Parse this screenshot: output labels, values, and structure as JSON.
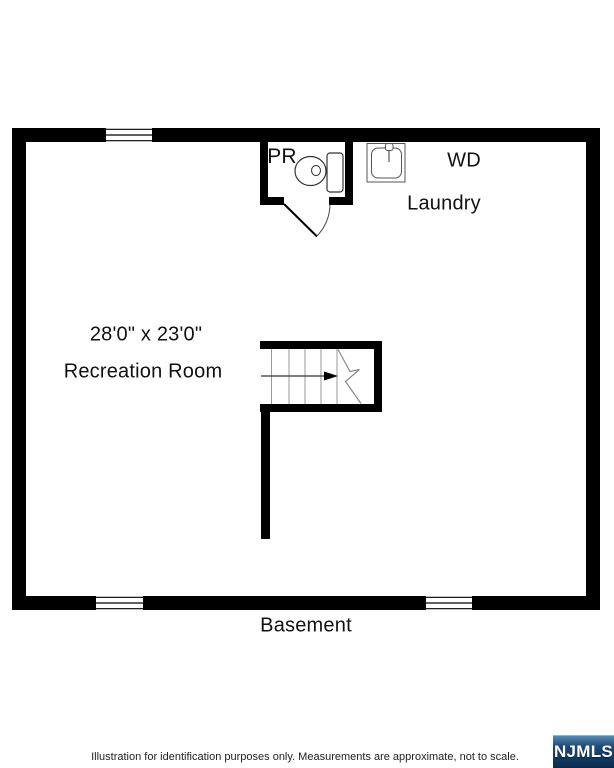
{
  "plan": {
    "powder_room": {
      "label": "PR"
    },
    "laundry_area": {
      "wd_label": "WD",
      "label": "Laundry"
    },
    "recreation_room": {
      "dimensions": "28'0\" x 23'0\"",
      "label": "Recreation Room"
    },
    "basement_label": "Basement"
  },
  "footer": {
    "disclaimer": "Illustration for identification purposes only. Measurements are approximate, not to scale.",
    "logo_text": "NJMLS"
  },
  "colors": {
    "wall": "#000000",
    "fixture_stroke": "#444444",
    "tread_stroke": "#999999",
    "logo_gradient_top": "#5e8fb5",
    "logo_gradient_mid": "#1c4a77",
    "logo_gradient_bottom": "#0a2a4c"
  }
}
